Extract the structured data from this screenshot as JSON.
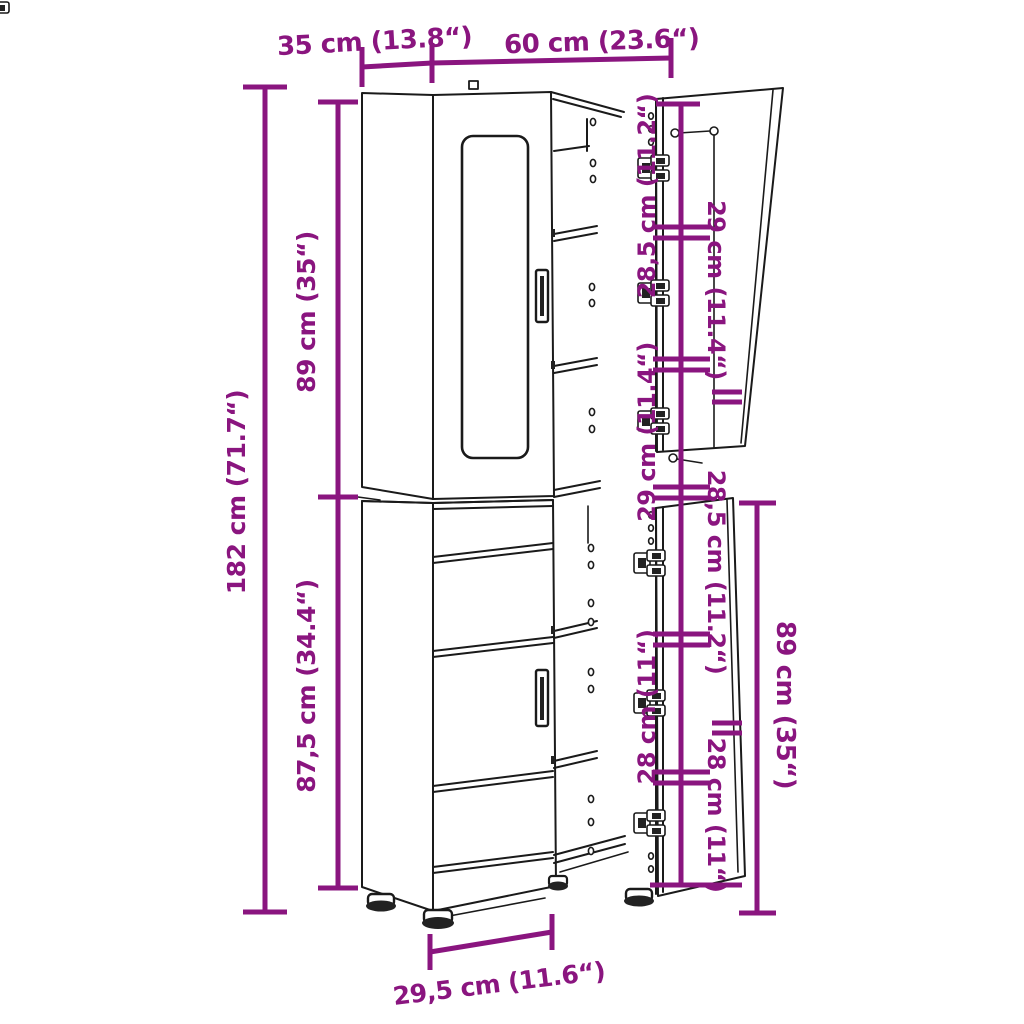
{
  "diagram": {
    "kind": "cabinet-dimension-diagram",
    "accent_color": "#8A157F",
    "line_color": "#1a1a1a",
    "background": "#ffffff",
    "labels": {
      "depth": "35 cm (13.8“)",
      "width": "60 cm (23.6“)",
      "total_height": "182 cm (71.7“)",
      "upper_height": "89 cm (35“)",
      "lower_height": "87,5 cm (34.4“)",
      "base_depth": "29,5 cm (11.6“)",
      "door_height": "89 cm (35“)",
      "shelf_gaps_left": [
        "28,5 cm (11.2“)",
        "29 cm (11.4“)",
        "28 cm (11“)"
      ],
      "shelf_gaps_right": [
        "29 cm (11.4“)",
        "28,5 cm (11.2“)",
        "28 cm (11“)"
      ]
    }
  }
}
